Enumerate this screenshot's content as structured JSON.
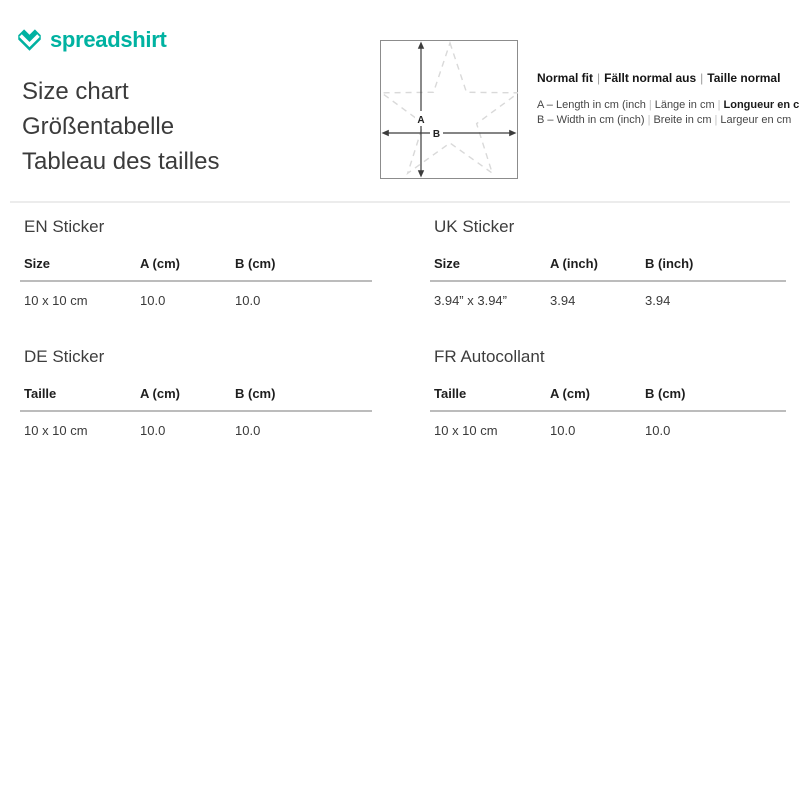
{
  "brand": {
    "name": "spreadshirt",
    "accent_color": "#00b2a1"
  },
  "title": {
    "lines": [
      "Size chart",
      "Größentabelle",
      "Tableau des tailles"
    ]
  },
  "diagram": {
    "label_a": "A",
    "label_b": "B"
  },
  "legend": {
    "separator": "|",
    "fit": {
      "segments": [
        "Normal fit",
        "Fällt normal aus",
        "Taille normal"
      ]
    },
    "rows": [
      {
        "segments": [
          "A – Length in cm (inch",
          "Länge in cm",
          "Longueur en cm"
        ]
      },
      {
        "segments": [
          "B – Width in cm (inch)",
          "Breite in cm",
          "Largeur en cm"
        ]
      }
    ]
  },
  "tables": [
    {
      "title": "EN Sticker",
      "headers": [
        "Size",
        "A (cm)",
        "B (cm)"
      ],
      "rows": [
        [
          "10 x 10 cm",
          "10.0",
          "10.0"
        ]
      ]
    },
    {
      "title": "UK Sticker",
      "headers": [
        "Size",
        "A (inch)",
        "B (inch)"
      ],
      "rows": [
        [
          "3.94” x 3.94”",
          "3.94",
          "3.94"
        ]
      ]
    },
    {
      "title": "DE Sticker",
      "headers": [
        "Taille",
        "A (cm)",
        "B (cm)"
      ],
      "rows": [
        [
          "10 x 10 cm",
          "10.0",
          "10.0"
        ]
      ]
    },
    {
      "title": "FR Autocollant",
      "headers": [
        "Taille",
        "A (cm)",
        "B (cm)"
      ],
      "rows": [
        [
          "10 x 10 cm",
          "10.0",
          "10.0"
        ]
      ]
    }
  ]
}
